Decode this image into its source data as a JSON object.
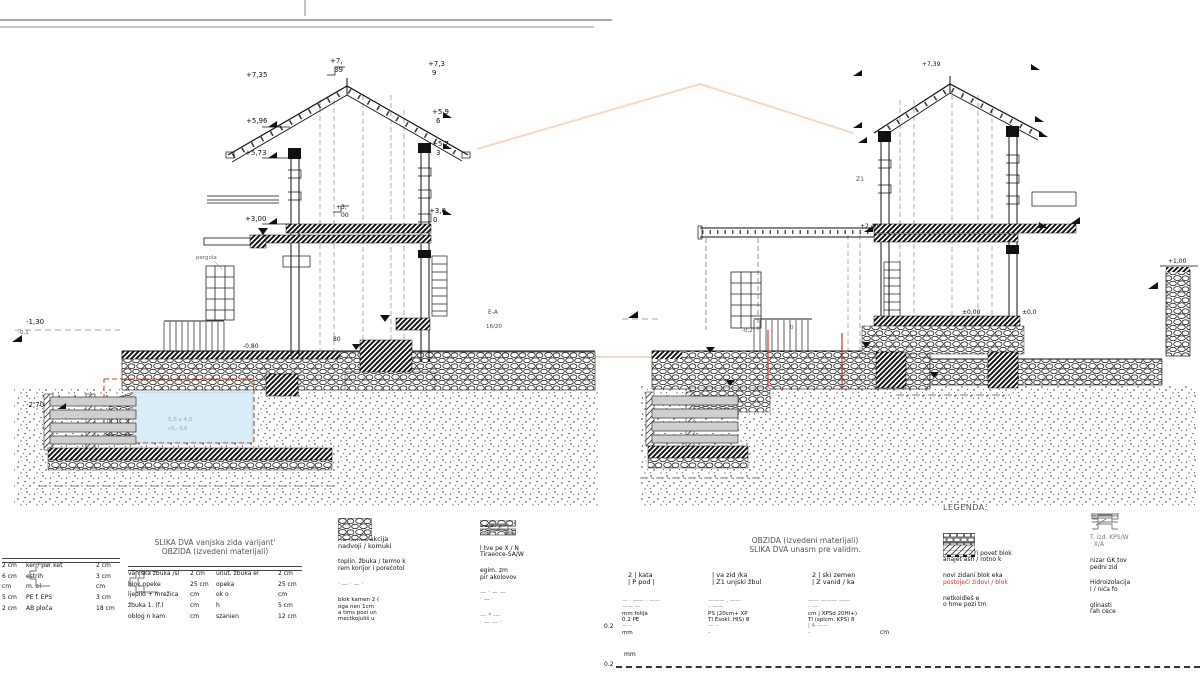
{
  "left_section": {
    "labels": {
      "r735": "+7,35",
      "r7": "+7,",
      "r39": "39",
      "r73": "+7,3",
      "r9": "9",
      "e596": "+5,96",
      "e59": "+5,9",
      "e6": "6",
      "e573": "+5,73",
      "e57": "+5,7",
      "e3": "3",
      "f300": "+3,00",
      "f3m": "+3,",
      "f00m": "00",
      "f30": "+3,0",
      "f0": "0",
      "m130": "-1,30",
      "m01": "-0,1",
      "m270": "-2,70",
      "m080": "-0,80",
      "d80": "80",
      "pergola": "pergola",
      "pool_size": "5,0 x 4,0",
      "pool_lvl": "+0,- 0,6",
      "ea": "E-A",
      "beam": "16/20"
    }
  },
  "right_section": {
    "labels": {
      "r739": "+7,39",
      "z1": "Z1",
      "l240": "+2,40",
      "l000": "±0,00",
      "l00": "±0,0",
      "l100": "+1,00",
      "m02": "-0,2",
      "m0": "0"
    }
  },
  "floor_legend": {
    "title1": "SLIKA DVA vanjska zida varijant'",
    "title2": "OBZIDA (izvedeni materijali)",
    "panelA": {
      "rows": [
        {
          "a": "2 cm",
          "b": "ker / par ket",
          "c": "2 cm"
        },
        {
          "a": "6 cm",
          "b": "estrih",
          "c": "3 cm"
        },
        {
          "a": "cm",
          "b": "m. el",
          "c": "cm"
        },
        {
          "a": "5 cm",
          "b": "PE f. EPS",
          "c": "3 cm"
        },
        {
          "a": "2 cm",
          "b": "AB ploča",
          "c": "18 cm"
        }
      ]
    },
    "panelB": {
      "rows": [
        {
          "a": "vanjska žbuka /sl",
          "b": "2 cm",
          "c": "unut. žbuka el",
          "d": "2 cm"
        },
        {
          "a": "blok opeke",
          "b": "25 cm",
          "c": "opeka",
          "d": "25 cm"
        },
        {
          "a": "ljepilo + mrežica",
          "b": "cm",
          "c": "ok o",
          "d": "cm"
        },
        {
          "a": "žbuka 1. (f.)",
          "b": "cm",
          "c": "h",
          "d": "5 cm"
        },
        {
          "a": "oblog n kam",
          "b": "cm",
          "c": "szanien",
          "d": "12 cm"
        }
      ]
    }
  },
  "materials_legend": {
    "left_rows": [
      {
        "l1": "— · —",
        "l2": ""
      },
      {
        "l1": "AB konstrukcija",
        "l2": "nadvoji / komuki"
      },
      {
        "l1": "toplin. žbuka / termo k",
        "l2": "rem korijor i porećotol"
      },
      {
        "l1": "· — · — ·",
        "l2": ""
      },
      {
        "l1": "blok kamen 2 (",
        "l2": "oga nen 1cm",
        "l3": "a tims pozi un",
        "l4": "mectkojuliš u"
      }
    ],
    "right_rows": [
      {
        "l1": "ŠLJB. B",
        "l2": "TUC. PS"
      },
      {
        "l1": "l tve pe X / N",
        "l2": "Tiraeoce-SA/W"
      },
      {
        "l1": "egim. zm",
        "l2": "pir akolovov"
      },
      {
        "l1": "— · — —",
        "l2": "· — ·"
      },
      {
        "l1": "--- * ---",
        "l2": "· — — ·"
      }
    ]
  },
  "assembly_legend": {
    "title1": "OBZIDA (izvedeni materijali)",
    "title2": "SLIKA DVA unasm pre validm.",
    "groups": [
      {
        "h1": "2 |  kata",
        "h2": "| P pod |",
        "r1": "— · ——  · ——",
        "r2": "—— —",
        "r3": "mm  folija",
        "r4": "0.2  PE",
        "r5": "— –",
        "r6": "mm"
      },
      {
        "h1": "|  va zid /ka",
        "h2": "| Z1 unjski žbul",
        "r1": "——— , ——",
        "r2": "– ——",
        "r3": "PS (20cm+ XP",
        "r4": "TI Esokl: HIS)  8",
        "r5": "— –",
        "r6": "–"
      },
      {
        "h1": "2 |  ski zemen",
        "h2": "| Z vanid / ka",
        "r1": "—— ——— ——",
        "r2": "– —",
        "r3": "cm | XPSd 20HI+)",
        "r4": "TI (splcm: KPS)  8",
        "r5": "| 4 ——",
        "r6": "–"
      }
    ],
    "margin": {
      "v1": "0.2",
      "v2": "0.2",
      "u1": "mm",
      "u2": "cm"
    }
  },
  "legenda": {
    "title": "LEGENDA:",
    "left_rows": [
      {
        "l1": "Beton",
        "l2": ""
      },
      {
        "l1": "zidni kon:tri povet blok",
        "l2": "anajet ash / rotno k"
      },
      {
        "l1": "novi zidani blok eka",
        "l2": "postojeći zidovi / blok"
      },
      {
        "l1": "netkoidleš e",
        "l2": "o hme pozi tm"
      }
    ],
    "right_rows": [
      {
        "l1": "— · —",
        "l2": "· — ·"
      },
      {
        "l1": "T. izd. KPS/W",
        "l2": "· X/A"
      },
      {
        "l1": "nizar GK tov",
        "l2": "pedni zid"
      },
      {
        "l1": "Hidroizolacija",
        "l2": "l / nića fo"
      },
      {
        "l1": "glinasti",
        "l2": "rah cece"
      }
    ]
  }
}
